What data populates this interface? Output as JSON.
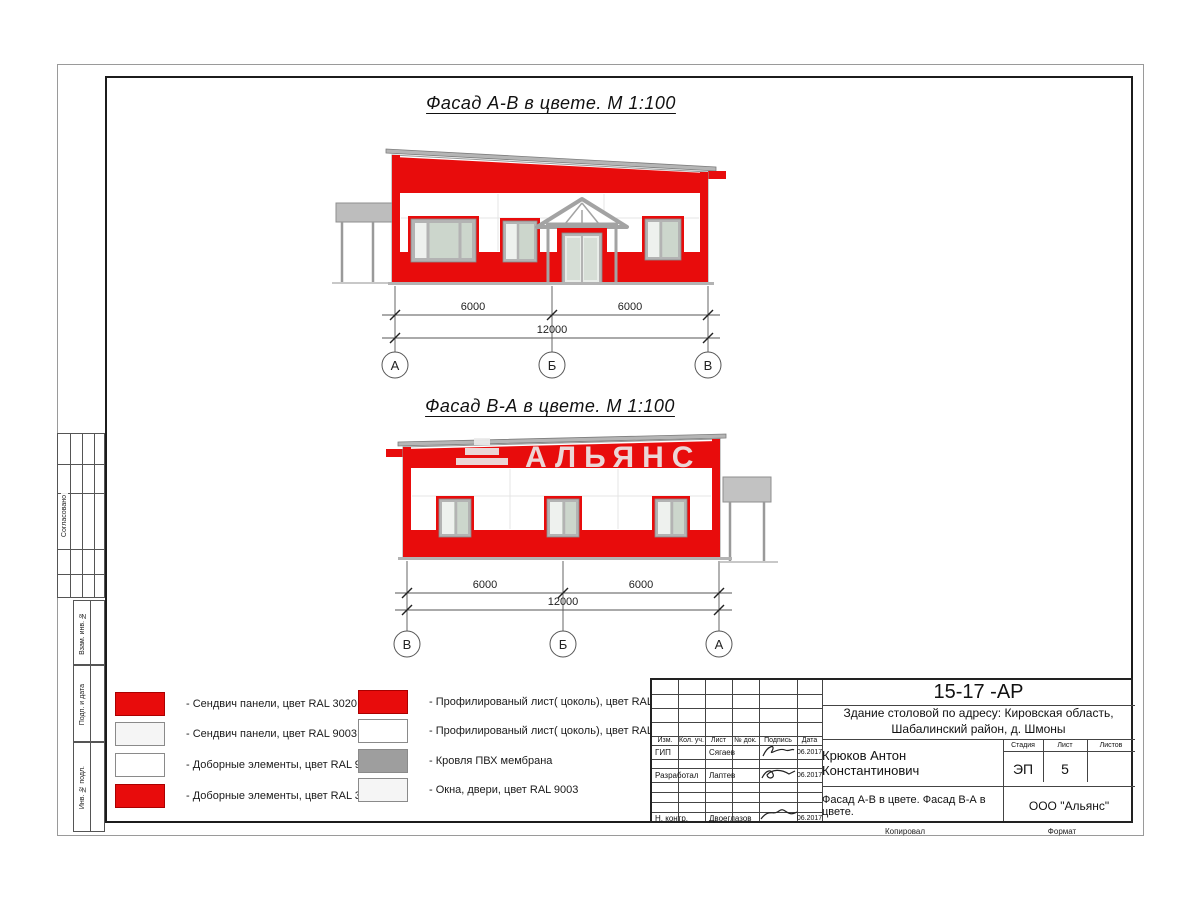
{
  "titles": {
    "facade_ab": "Фасад А-В в цвете.  М 1:100",
    "facade_ba": "Фасад В-А в цвете.  М 1:100"
  },
  "watermark": {
    "text": "АЛЬЯНС"
  },
  "facade_ab": {
    "dims": [
      "6000",
      "6000",
      "12000"
    ],
    "axes": [
      "А",
      "Б",
      "В"
    ]
  },
  "facade_ba": {
    "dims": [
      "6000",
      "6000",
      "12000"
    ],
    "axes": [
      "В",
      "Б",
      "А"
    ]
  },
  "legend": {
    "col1": [
      {
        "label": "- Сендвич панели, цвет RAL 3020",
        "swatch": "red"
      },
      {
        "label": "- Сендвич панели, цвет RAL 9003",
        "swatch": "offwhite"
      },
      {
        "label": "- Доборные элементы, цвет RAL 9003",
        "swatch": "white"
      },
      {
        "label": "- Доборные элементы, цвет RAL 3020",
        "swatch": "red"
      }
    ],
    "col2": [
      {
        "label": "- Профилированый лист( цоколь), цвет RAL 3020",
        "swatch": "red"
      },
      {
        "label": "- Профилированый лист( цоколь), цвет RAL 9003",
        "swatch": "white"
      },
      {
        "label": "- Кровля ПВХ мембрана",
        "swatch": "gray"
      },
      {
        "label": "- Окна, двери, цвет RAL 9003",
        "swatch": "offwhite"
      }
    ]
  },
  "titleblock": {
    "doc_number": "15-17 -АР",
    "object_line1": "Здание столовой по адресу: Кировская область,",
    "object_line2": "Шабалинский район, д. Шмоны",
    "columns": [
      "Изм.",
      "Кол. уч.",
      "Лист",
      "№ док.",
      "Подпись",
      "Дата"
    ],
    "rows": [
      {
        "role": "ГИП",
        "name": "Сягаев",
        "date": "06.2017"
      },
      {
        "role": "Разработал",
        "name": "Лаптев",
        "date": "06.2017"
      },
      {
        "role": "Н. контр.",
        "name": "Двоеглазов",
        "date": "06.2017"
      }
    ],
    "chief": "Крюков Антон Константинович",
    "stage_label": "Стадия",
    "sheet_label": "Лист",
    "sheets_label": "Листов",
    "stage": "ЭП",
    "sheet_no": "5",
    "sheets_total": "",
    "drawing_title": "Фасад А-В в цвете. Фасад В-А в цвете.",
    "company": "ООО \"Альянс\"",
    "copied_label": "Копировал",
    "format_label": "Формат"
  },
  "sidebar": {
    "approved": "Согласовано",
    "vzam": "Взам. инв. №",
    "podp": "Подп. и дата",
    "inv": "Инв. № подл."
  },
  "colors": {
    "ral3020": "#e80c0c",
    "ral9003": "#f6f6f6",
    "roof-gray": "#9e9e9e",
    "glass": "#ccd6cc",
    "frame-gray": "#b3b3b3"
  }
}
